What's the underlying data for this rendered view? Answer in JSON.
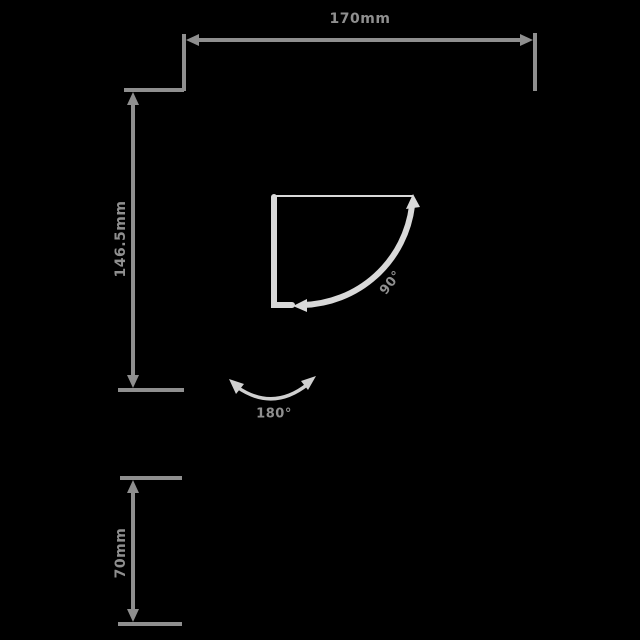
{
  "colors": {
    "background": "#000000",
    "dimension_gray": "#8f8f8f",
    "shape_light_gray": "#d9d9d9",
    "arc_arrow_gray": "#d0d0d0"
  },
  "dimensions": {
    "top_width": {
      "label": "170mm"
    },
    "left_height": {
      "label": "146.5mm"
    },
    "bottom_height": {
      "label": "70mm"
    }
  },
  "angles": {
    "swing": {
      "label": "90°"
    },
    "sweep": {
      "label": "180°"
    }
  }
}
